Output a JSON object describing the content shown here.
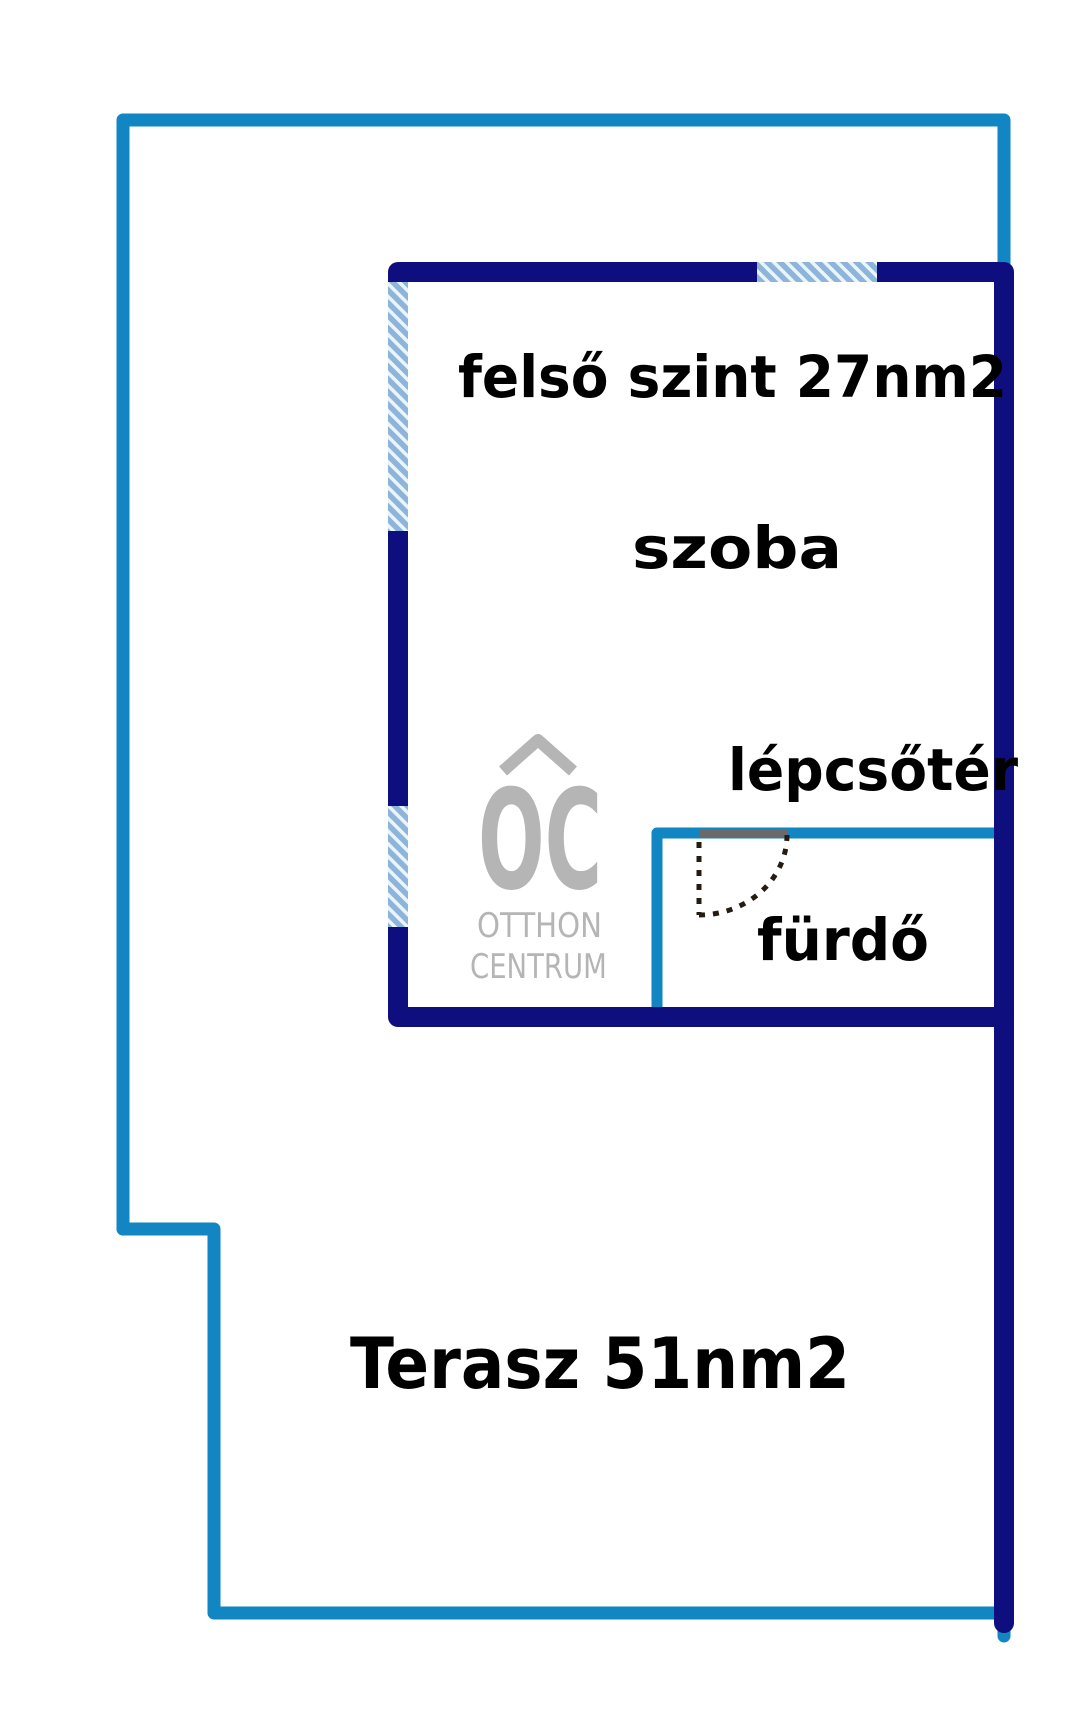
{
  "page": {
    "width_px": 1080,
    "height_px": 1720,
    "background": "#ffffff",
    "kind": "real-estate floor plan"
  },
  "floor_plan": {
    "title_label": "felső szint 27nm2",
    "room_label": "szoba",
    "stairwell_label": "lépcsőtér",
    "bathroom_label": "fürdő",
    "terrace_label": "Terasz 51nm2"
  },
  "watermark_logo": {
    "monogram": "OC",
    "line1": "OTTHON",
    "line2": "CENTRUM"
  },
  "colors": {
    "boundary_blue": "#1186c3",
    "wall_navy": "#0e0e7e",
    "window_fill": "#8fb4d9",
    "window_stripe": "#e9f5fc",
    "door_header_gray": "#6a6a6a",
    "door_swing": "#241c12",
    "logo_gray": "#b5b5b5",
    "label_text": "#000000"
  }
}
